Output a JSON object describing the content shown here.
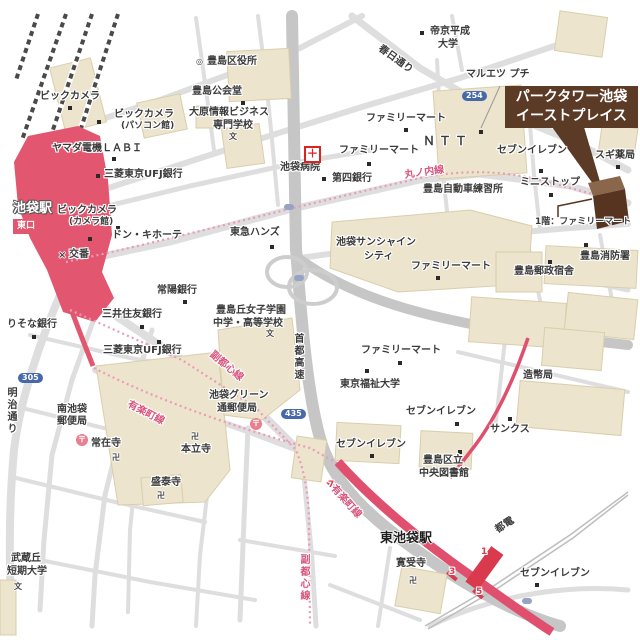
{
  "title_box": {
    "line1": "パークタワー池袋",
    "line2": "イーストプレイス",
    "note": "1階：ファミリーマート"
  },
  "stations": {
    "ikebukuro": "池袋駅",
    "higashi_ikebukuro": "東池袋駅",
    "east_exit": "東口"
  },
  "rail_lines": {
    "marunouchi": "丸ノ内線",
    "yurakucho": "有楽町線",
    "fukutoshin": "副都心線",
    "toden": "都電"
  },
  "roads": {
    "kasuga_dori": "春日通り",
    "meiji_dori": "明治通り",
    "shuto_expressway": "首都高速"
  },
  "route_shields": {
    "s254": "254",
    "s305": "305",
    "s435": "435"
  },
  "exits": {
    "e1": "1",
    "e3": "3",
    "e5": "5",
    "e7": "7"
  },
  "marks": {
    "temple": "卍",
    "school": "文",
    "post": "〒",
    "koban": "×",
    "ward": "◎"
  },
  "labels": {
    "bic1": "ビックカメラ",
    "bic2a": "ビックカメラ",
    "bic2b": "(パソコン館)",
    "bic3a": "ビックカメラ",
    "bic3b": "(カメラ館)",
    "yamada": "ヤマダ電機ＬＡＢＩ",
    "ufj1": "三菱東京UFJ銀行",
    "ufj2": "三菱東京UFJ銀行",
    "ward_office": "豊島区役所",
    "kokaido": "豊島公会堂",
    "ohara1": "大原情報ビジネス",
    "ohara2": "専門学校",
    "teikyo1": "帝京平成",
    "teikyo2": "大学",
    "maruetsu": "マルエツ プチ",
    "famima": "ファミリーマート",
    "hospital": "池袋病院",
    "daishi_bank": "第四銀行",
    "ntt": "ＮＴＴ",
    "seven": "セブンイレブン",
    "ministop": "ミニストップ",
    "sugi": "スギ薬局",
    "driving_school": "豊島自動車練習所",
    "donki": "ドン・キホーテ",
    "koban": "交番",
    "joyo_bank": "常陽銀行",
    "smbc_bank": "三井住友銀行",
    "risona_bank": "りそな銀行",
    "tokyu_hands": "東急ハンズ",
    "sunshine1": "池袋サンシャイン",
    "sunshine2": "シティ",
    "fire_station": "豊島消防署",
    "yusei": "豊島郵政宿舎",
    "girls_school1": "豊島丘女子学園",
    "girls_school2": "中学・高等学校",
    "minami_post1": "南池袋",
    "minami_post2": "郵便局",
    "green_post1": "池袋グリーン",
    "green_post2": "通郵便局",
    "jozaiji": "常在寺",
    "honryuji": "本立寺",
    "seitaiji": "盛泰寺",
    "kanjuji": "寛受寺",
    "fukushi_univ": "東京福祉大学",
    "sankus": "サンクス",
    "mint": "造幣局",
    "library1": "豊島区立",
    "library2": "中央図書館",
    "musashi1": "武蔵丘",
    "musashi2": "短期大学"
  }
}
